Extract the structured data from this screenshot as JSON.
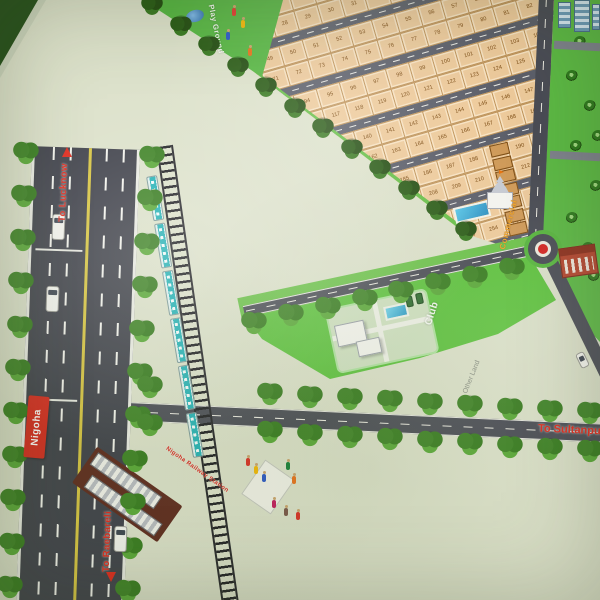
{
  "labels": {
    "to_lucknow": "To Lucknow",
    "to_raebareli": "To Raebareli",
    "to_sultanpur": "To Sultanpur",
    "nigoha_sign": "Nigoha",
    "play_ground": "Play Ground",
    "club": "Club",
    "commercial": "Commercial",
    "other_land": "Other Land",
    "railway_station": "Nigoha Railway Station"
  },
  "colors": {
    "land_cream": "#dce1ca",
    "plot_tan": "#edca9b",
    "park_green": "#5cb944",
    "road_dark": "#4a4c55",
    "highway_dark": "#3f414a",
    "rail_black": "#202024",
    "train_teal": "#26b2b6",
    "label_red": "#e0291c",
    "sign_red": "#d62b1f",
    "pool_blue": "#2e9cc8",
    "commercial_orange": "#f0a227",
    "roundabout_red": "#d42420"
  },
  "plot_grid": {
    "blocks": 6,
    "rows_per_block": 2,
    "plots_per_row": 22,
    "start_number": 1
  },
  "train": {
    "coaches": 6
  },
  "features": {
    "playground": "play ground with pond and kids",
    "club": "clubhouse with swimming pool and parked cars",
    "commercial": "commercial shop strip with temple and water feature",
    "roundabout": "roundabout with red center",
    "station": "railway station with platforms",
    "market": "roadside market with people",
    "school": "red building near roundabout",
    "towers": "apartment towers at top right corner"
  }
}
